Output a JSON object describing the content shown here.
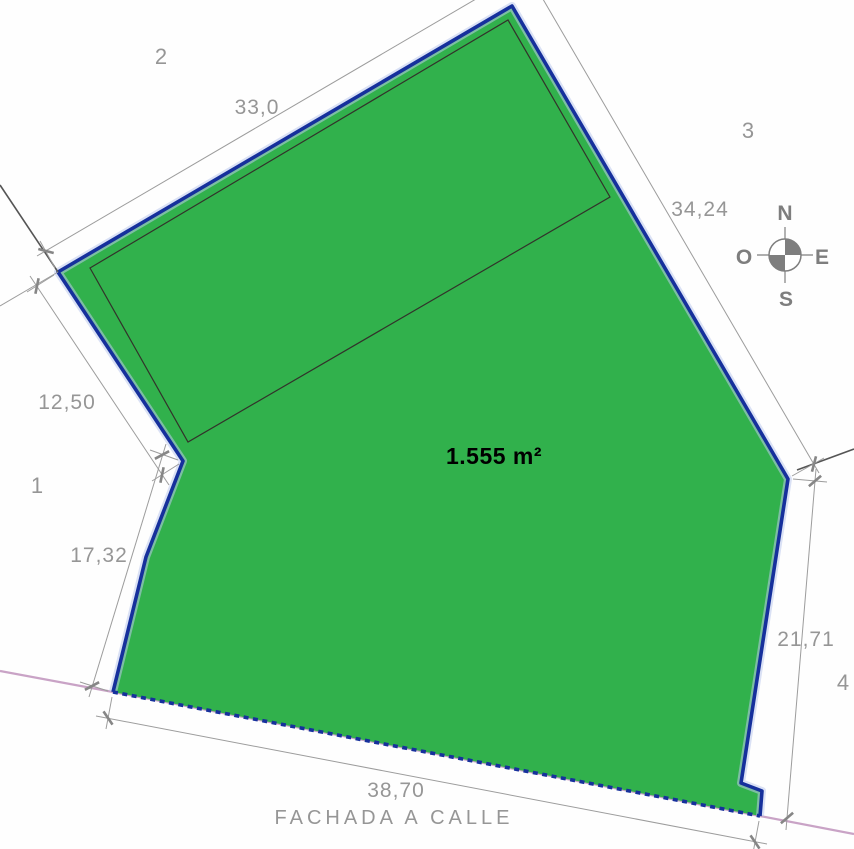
{
  "plot": {
    "area_label": "1.555 m²",
    "street_label": "FACHADA A CALLE"
  },
  "dimensions": {
    "top_edge": "33,0",
    "right_edge": "34,24",
    "left_upper_edge": "12,50",
    "left_lower_edge": "17,32",
    "right_lower_edge": "21,71",
    "bottom_edge": "38,70"
  },
  "corner_labels": {
    "corner_1": "1",
    "corner_2": "2",
    "corner_3": "3",
    "corner_4": "4"
  },
  "compass": {
    "north": "N",
    "west": "O",
    "east": "E",
    "south": "S"
  },
  "colors": {
    "parcel_fill": "#31b14c",
    "boundary_blue": "#16309c",
    "boundary_halo": "#bcc8ec",
    "street_line_pink": "#c9a3c6",
    "inner_outline": "#32322a",
    "neighbor_line_dark": "#555555",
    "dimension_gray": "#9c9c9c",
    "tick_gray": "#868686",
    "text_gray": "#969696",
    "compass_gray": "#7e7e7e",
    "area_text": "#000000"
  }
}
